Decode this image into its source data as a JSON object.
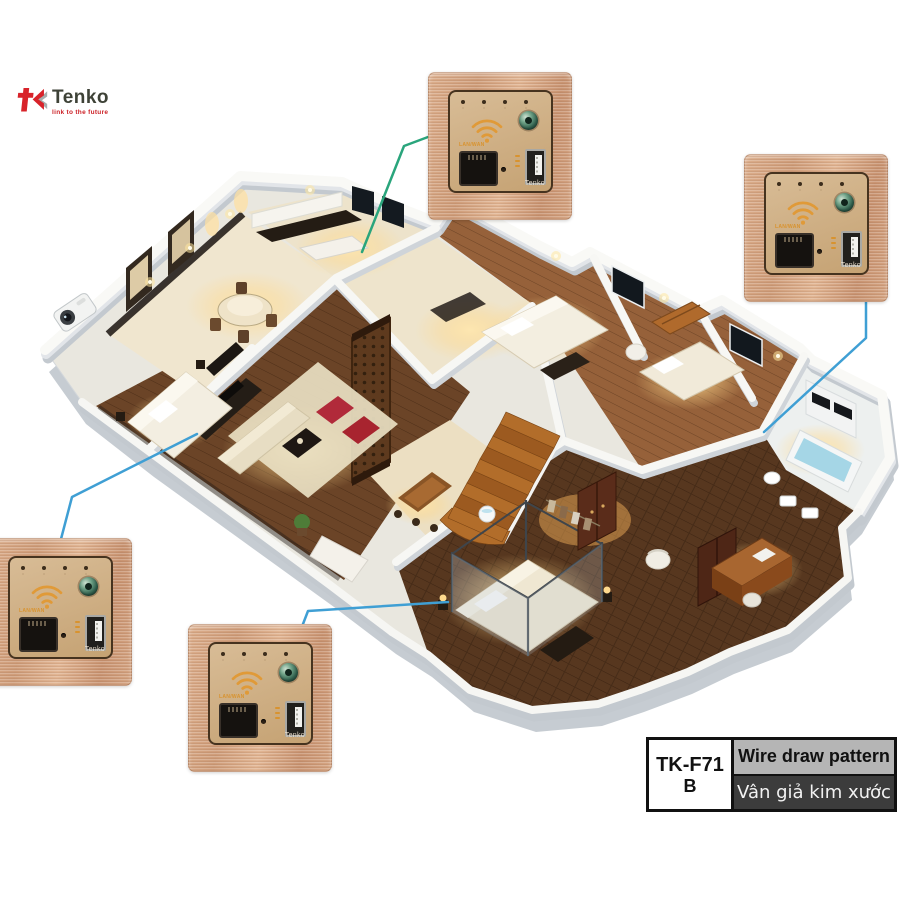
{
  "brand": {
    "name": "Tenko",
    "tagline": "link to the future"
  },
  "device": {
    "port_label": "LAN/WAN",
    "brand_mark": "Tenko",
    "count": 4
  },
  "product_label": {
    "model": "TK-F71",
    "variant": "B",
    "pattern_en": "Wire draw pattern",
    "pattern_vi": "Vân giả kim xước"
  },
  "icons": {
    "tk-logo-icon": "red t glyph with double chevron",
    "wifi-icon": "three orange arcs with dot",
    "ethernet-port": "black RJ45 jack",
    "usb-port": "USB-A socket",
    "power-button": "round green button",
    "led-indicators": "4 status dots"
  },
  "colors": {
    "plate_rose_gold": "#d2a17f",
    "panel_gold": "#cdb18c",
    "wifi_orange": "#e09a38",
    "button_green": "#3f7a64",
    "connector_teal": "#2aa57c",
    "connector_blue": "#3f9fd4",
    "logo_red": "#d8232a",
    "label_gray": "#b5b5b5",
    "label_dark": "#3c3c3c"
  }
}
